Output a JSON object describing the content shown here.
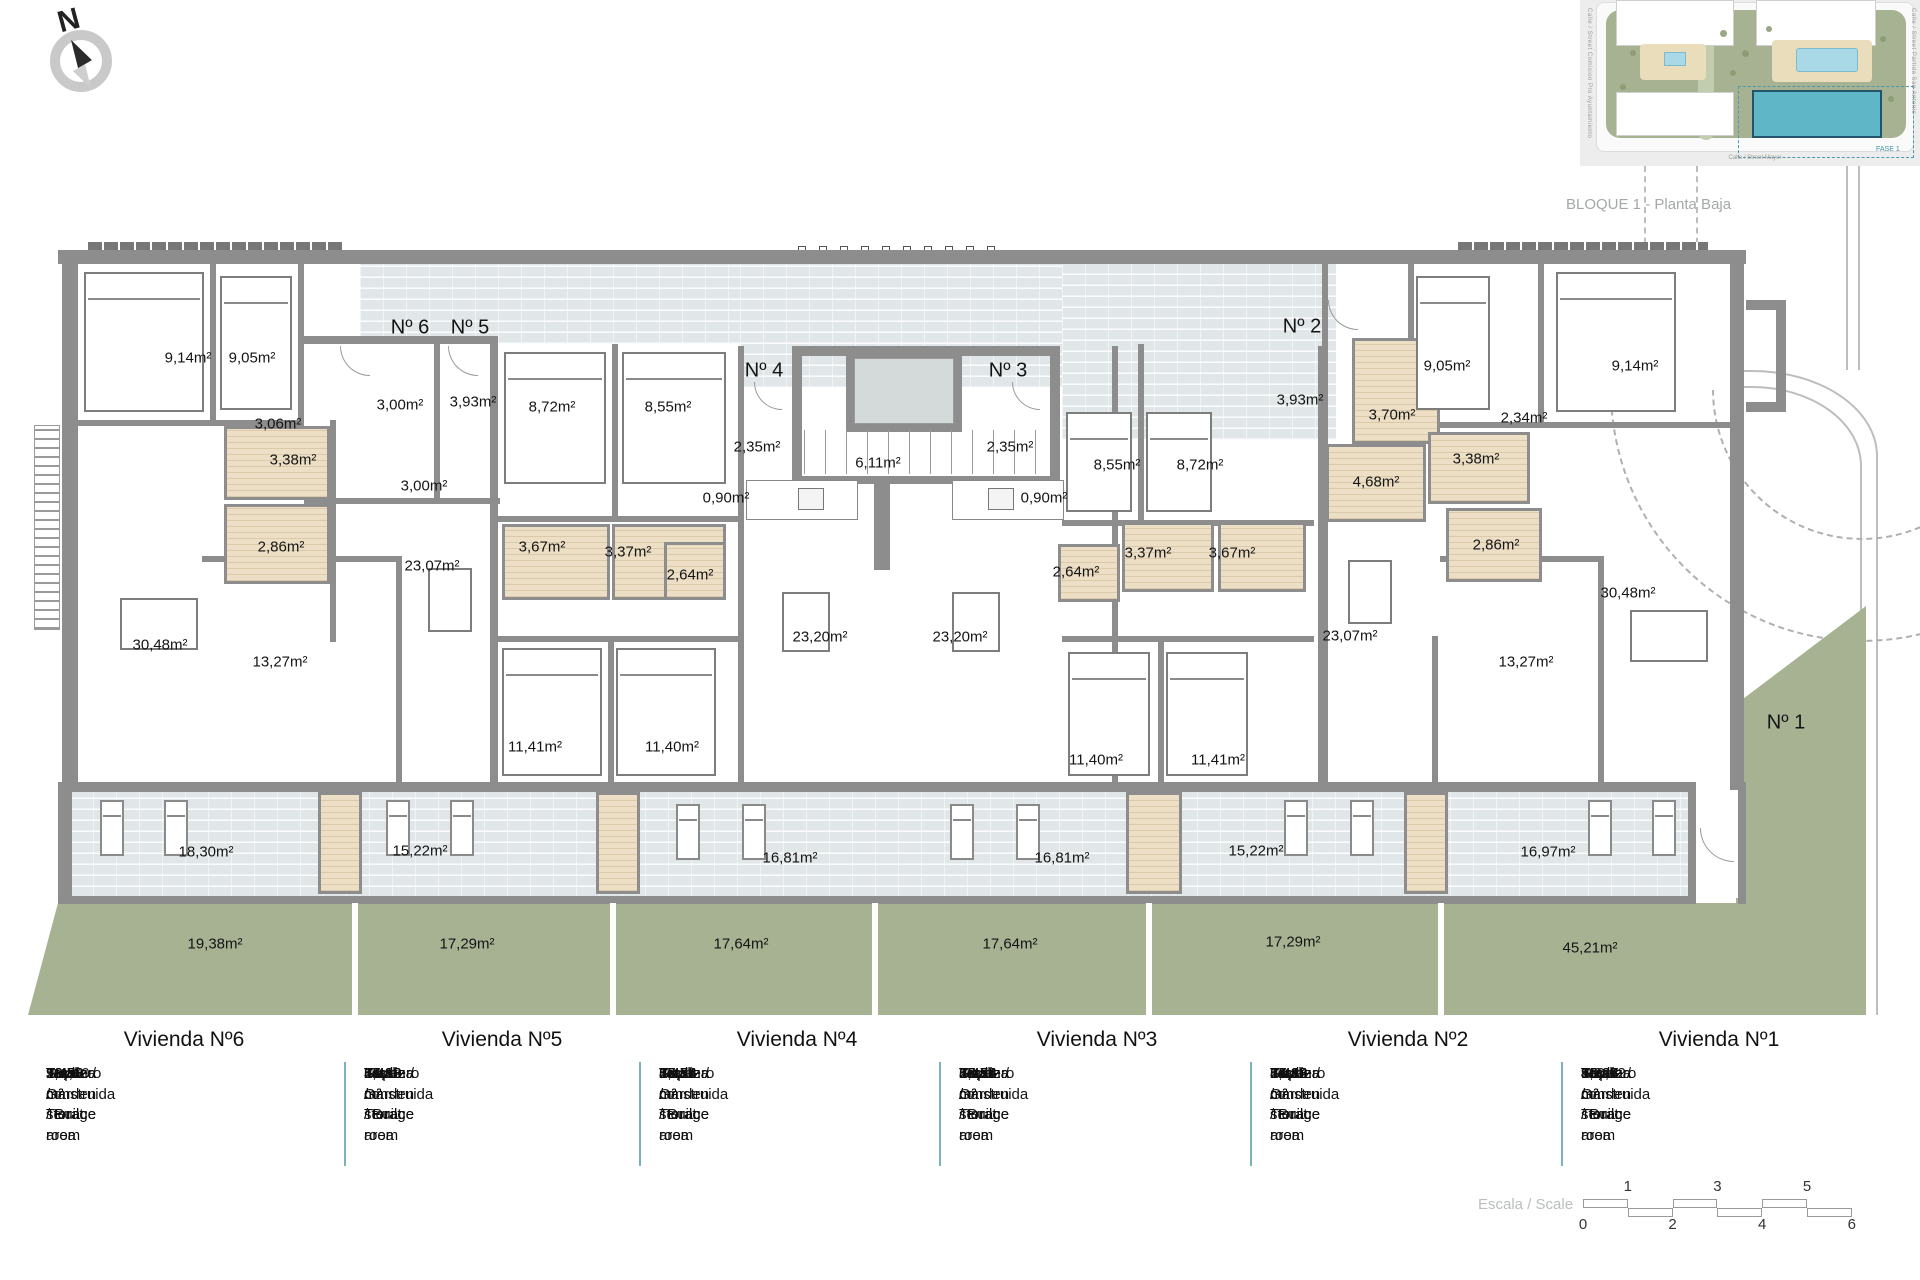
{
  "meta": {
    "block_title": "BLOQUE 1 - Planta Baja",
    "north_label": "N"
  },
  "site_plan": {
    "street_bottom": "Calle / Street Mayor",
    "street_left": "Calle / Street Comision Pro Ayuntamiento",
    "street_right": "Calle / Street Partida San Antonio",
    "phase_label": "FASE 1"
  },
  "plan": {
    "unit_markers": [
      {
        "t": "Nº 6",
        "x": 410,
        "y": 328
      },
      {
        "t": "Nº 5",
        "x": 470,
        "y": 328
      },
      {
        "t": "Nº 4",
        "x": 764,
        "y": 371
      },
      {
        "t": "Nº 3",
        "x": 1008,
        "y": 371
      },
      {
        "t": "Nº 2",
        "x": 1302,
        "y": 327
      },
      {
        "t": "Nº 1",
        "x": 1786,
        "y": 723
      }
    ],
    "area_labels": [
      {
        "t": "9,14m²",
        "x": 188,
        "y": 358
      },
      {
        "t": "9,05m²",
        "x": 252,
        "y": 358
      },
      {
        "t": "3,06m²",
        "x": 278,
        "y": 424
      },
      {
        "t": "3,38m²",
        "x": 293,
        "y": 460
      },
      {
        "t": "2,86m²",
        "x": 281,
        "y": 547
      },
      {
        "t": "30,48m²",
        "x": 160,
        "y": 645
      },
      {
        "t": "13,27m²",
        "x": 280,
        "y": 662
      },
      {
        "t": "3,00m²",
        "x": 400,
        "y": 405
      },
      {
        "t": "3,93m²",
        "x": 473,
        "y": 402
      },
      {
        "t": "3,00m²",
        "x": 424,
        "y": 486
      },
      {
        "t": "23,07m²",
        "x": 432,
        "y": 566
      },
      {
        "t": "8,72m²",
        "x": 552,
        "y": 407
      },
      {
        "t": "8,55m²",
        "x": 668,
        "y": 407
      },
      {
        "t": "3,67m²",
        "x": 542,
        "y": 547
      },
      {
        "t": "3,37m²",
        "x": 628,
        "y": 552
      },
      {
        "t": "2,64m²",
        "x": 690,
        "y": 575
      },
      {
        "t": "11,41m²",
        "x": 535,
        "y": 747
      },
      {
        "t": "11,40m²",
        "x": 672,
        "y": 747
      },
      {
        "t": "2,35m²",
        "x": 757,
        "y": 447
      },
      {
        "t": "0,90m²",
        "x": 726,
        "y": 498
      },
      {
        "t": "6,11m²",
        "x": 878,
        "y": 463
      },
      {
        "t": "23,20m²",
        "x": 820,
        "y": 637
      },
      {
        "t": "23,20m²",
        "x": 960,
        "y": 637
      },
      {
        "t": "2,35m²",
        "x": 1010,
        "y": 447
      },
      {
        "t": "0,90m²",
        "x": 1044,
        "y": 498
      },
      {
        "t": "8,55m²",
        "x": 1117,
        "y": 465
      },
      {
        "t": "8,72m²",
        "x": 1200,
        "y": 465
      },
      {
        "t": "2,64m²",
        "x": 1076,
        "y": 572
      },
      {
        "t": "3,37m²",
        "x": 1148,
        "y": 553
      },
      {
        "t": "3,67m²",
        "x": 1232,
        "y": 553
      },
      {
        "t": "11,40m²",
        "x": 1096,
        "y": 760
      },
      {
        "t": "11,41m²",
        "x": 1218,
        "y": 760
      },
      {
        "t": "3,93m²",
        "x": 1300,
        "y": 400
      },
      {
        "t": "3,70m²",
        "x": 1392,
        "y": 415
      },
      {
        "t": "9,05m²",
        "x": 1447,
        "y": 366
      },
      {
        "t": "2,34m²",
        "x": 1524,
        "y": 418
      },
      {
        "t": "9,14m²",
        "x": 1635,
        "y": 366
      },
      {
        "t": "4,68m²",
        "x": 1376,
        "y": 482
      },
      {
        "t": "3,38m²",
        "x": 1476,
        "y": 459
      },
      {
        "t": "2,86m²",
        "x": 1496,
        "y": 545
      },
      {
        "t": "23,07m²",
        "x": 1350,
        "y": 636
      },
      {
        "t": "13,27m²",
        "x": 1526,
        "y": 662
      },
      {
        "t": "30,48m²",
        "x": 1628,
        "y": 593
      },
      {
        "t": "18,30m²",
        "x": 206,
        "y": 852
      },
      {
        "t": "15,22m²",
        "x": 420,
        "y": 851
      },
      {
        "t": "16,81m²",
        "x": 790,
        "y": 858
      },
      {
        "t": "16,81m²",
        "x": 1062,
        "y": 858
      },
      {
        "t": "15,22m²",
        "x": 1256,
        "y": 851
      },
      {
        "t": "16,97m²",
        "x": 1548,
        "y": 852
      },
      {
        "t": "19,38m²",
        "x": 215,
        "y": 944
      },
      {
        "t": "17,29m²",
        "x": 467,
        "y": 944
      },
      {
        "t": "17,64m²",
        "x": 741,
        "y": 944
      },
      {
        "t": "17,64m²",
        "x": 1010,
        "y": 944
      },
      {
        "t": "17,29m²",
        "x": 1293,
        "y": 942
      },
      {
        "t": "45,21m²",
        "x": 1590,
        "y": 948
      }
    ]
  },
  "table": {
    "row_labels": [
      "Sup. construida / Built area",
      "Terraza / Terrace",
      "Trastero / storage room",
      "Total",
      "Jardín / Garden"
    ],
    "units": [
      {
        "name": "Vivienda Nº6",
        "values": [
          "90,60 m²",
          "18,30 m²",
          "2,47 m²",
          "111,60 m²",
          "19,38 m²"
        ]
      },
      {
        "name": "Vivienda Nº5",
        "values": [
          "64,18 m²",
          "15,22 m²",
          "2,40 m²",
          "81,80 m²",
          "17,29 m²"
        ]
      },
      {
        "name": "Vivienda Nº4",
        "values": [
          "63,76 m²",
          "16,81 m²",
          "2,47 m²",
          "83,04 m²",
          "17,64 m²"
        ]
      },
      {
        "name": "Vivienda Nº3",
        "values": [
          "63,76 m²",
          "16,81 m²",
          "2,47 m²",
          "83,04 m²",
          "17,64 m²"
        ]
      },
      {
        "name": "Vivienda Nº2",
        "values": [
          "64,18 m²",
          "15,22 m²",
          "2,44 m²",
          "81,84 m²",
          "17,29 m²"
        ]
      },
      {
        "name": "Vivienda Nº1",
        "values": [
          "90,03 m²",
          "16,97 m²",
          "3,62 m²",
          "110,62 m²",
          "45,21 m²"
        ]
      }
    ]
  },
  "scale": {
    "label": "Escala / Scale",
    "top_ticks": [
      "1",
      "3",
      "5"
    ],
    "bottom_ticks": [
      "0",
      "2",
      "4",
      "6"
    ]
  }
}
